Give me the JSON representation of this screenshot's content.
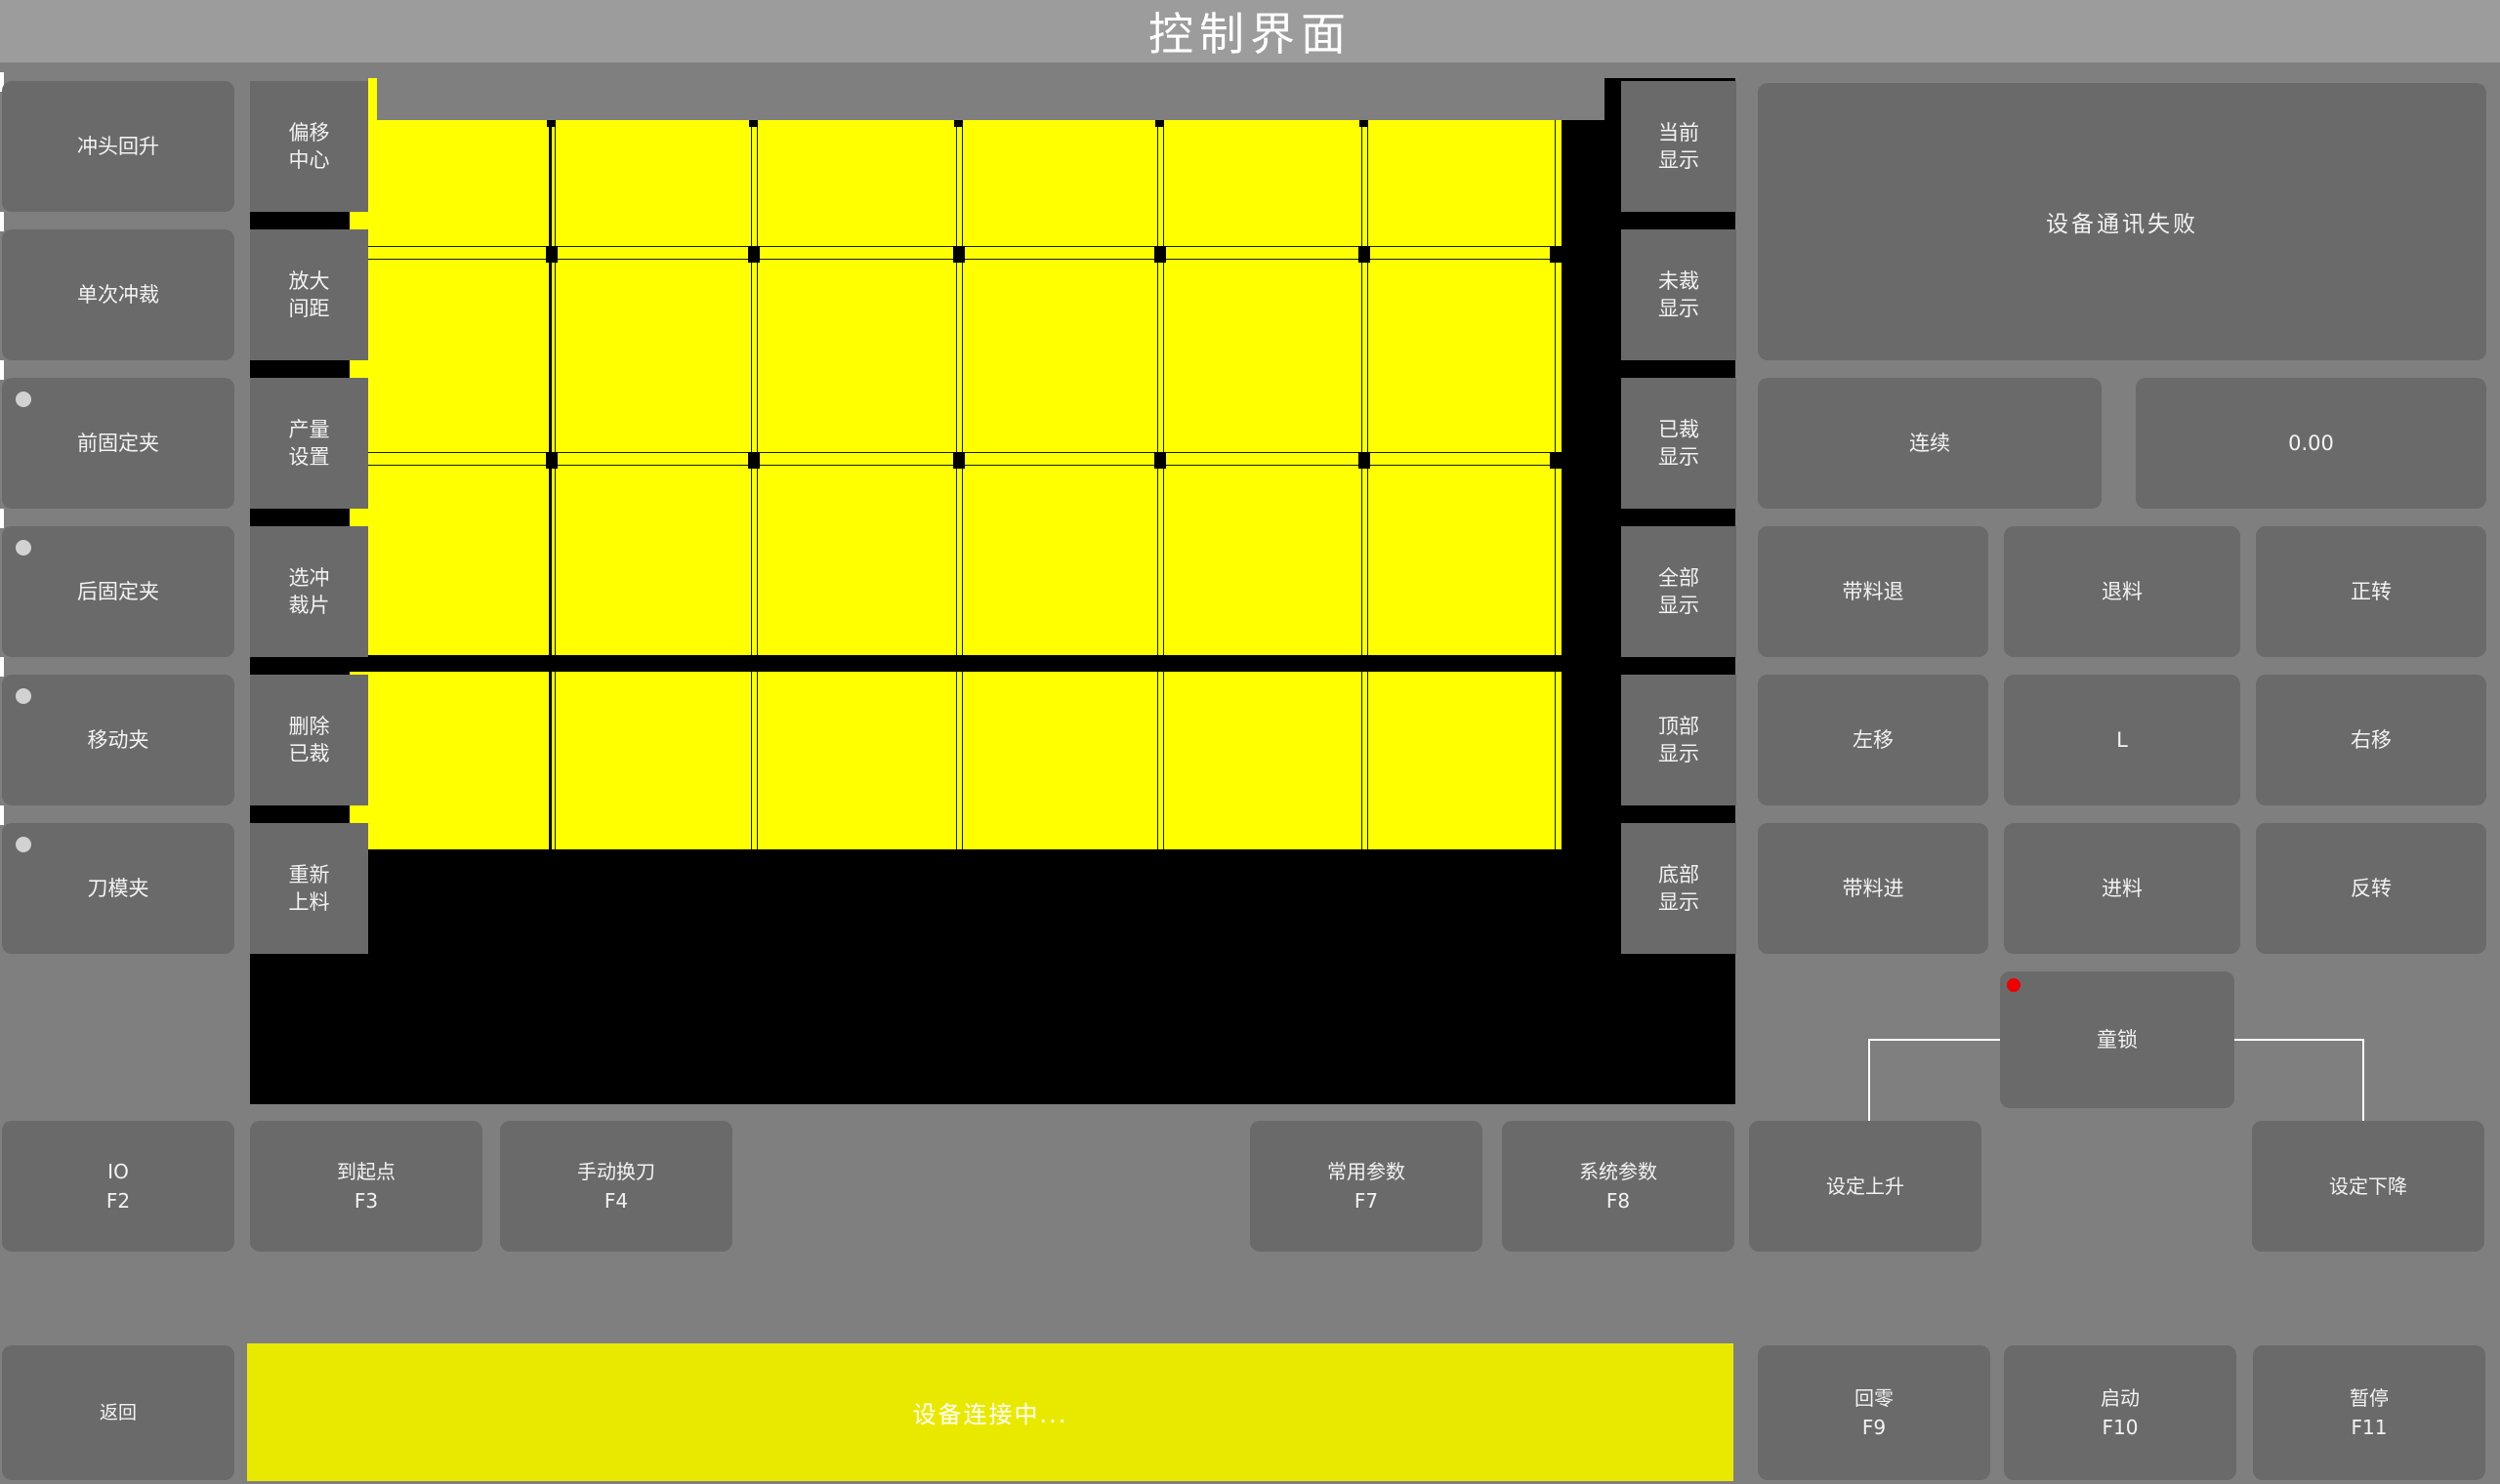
{
  "title": "控制界面",
  "colors": {
    "background": "#7f7f7f",
    "titlebar": "#9c9c9c",
    "button": "#6a6a6a",
    "canvas": "#000000",
    "sheet": "#ffff00",
    "statusbar_yellow": "#e9e900",
    "indicator_red": "#ee0000",
    "indicator_gray": "#d2d2d2",
    "text": "#f2f2f2"
  },
  "left_panel": {
    "buttons": [
      {
        "label": "冲头回升",
        "indicator": false
      },
      {
        "label": "单次冲裁",
        "indicator": false
      },
      {
        "label": "前固定夹",
        "indicator": true
      },
      {
        "label": "后固定夹",
        "indicator": true
      },
      {
        "label": "移动夹",
        "indicator": true
      },
      {
        "label": "刀模夹",
        "indicator": true
      }
    ]
  },
  "tool_panel": {
    "buttons": [
      {
        "line1": "偏移",
        "line2": "中心"
      },
      {
        "line1": "放大",
        "line2": "间距"
      },
      {
        "line1": "产量",
        "line2": "设置"
      },
      {
        "line1": "选冲",
        "line2": "裁片"
      },
      {
        "line1": "删除",
        "line2": "已裁"
      },
      {
        "line1": "重新",
        "line2": "上料"
      }
    ]
  },
  "display_panel": {
    "buttons": [
      {
        "line1": "当前",
        "line2": "显示"
      },
      {
        "line1": "未裁",
        "line2": "显示"
      },
      {
        "line1": "已裁",
        "line2": "显示"
      },
      {
        "line1": "全部",
        "line2": "显示"
      },
      {
        "line1": "顶部",
        "line2": "显示"
      },
      {
        "line1": "底部",
        "line2": "显示"
      }
    ]
  },
  "sheet_preview": {
    "columns": 6,
    "rows": 4,
    "description": "yellow material sheet with black cut gridlines on black canvas"
  },
  "status_panel": {
    "message": "设备通讯失败"
  },
  "mode_row": {
    "continuous_label": "连续",
    "value": "0.00"
  },
  "jog_panel": {
    "buttons": [
      "带料退",
      "退料",
      "正转",
      "左移",
      "L",
      "右移",
      "带料进",
      "进料",
      "反转"
    ]
  },
  "child_lock": {
    "label": "童锁"
  },
  "function_row": {
    "buttons": [
      {
        "line1": "IO",
        "line2": "F2"
      },
      {
        "line1": "到起点",
        "line2": "F3"
      },
      {
        "line1": "手动换刀",
        "line2": "F4"
      },
      {
        "line1": "常用参数",
        "line2": "F7"
      },
      {
        "line1": "系统参数",
        "line2": "F8"
      },
      {
        "line1": "设定上升",
        "line2": ""
      },
      {
        "line1": "设定下降",
        "line2": ""
      }
    ]
  },
  "bottom_bar": {
    "back_label": "返回",
    "status_message": "设备连接中...",
    "buttons": [
      {
        "line1": "回零",
        "line2": "F9"
      },
      {
        "line1": "启动",
        "line2": "F10"
      },
      {
        "line1": "暂停",
        "line2": "F11"
      }
    ]
  }
}
